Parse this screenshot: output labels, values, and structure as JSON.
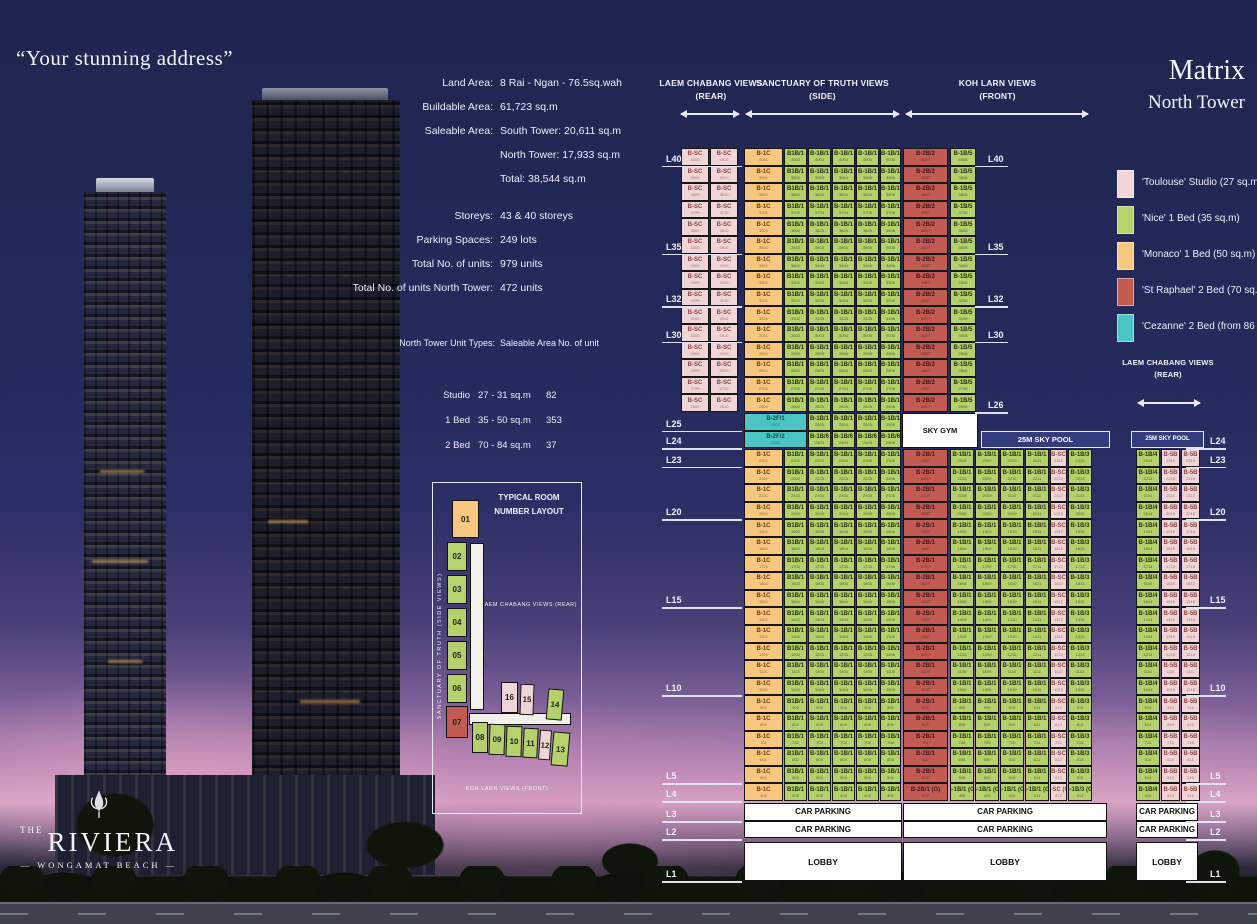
{
  "page": {
    "quote": "“Your stunning address”"
  },
  "title": {
    "main": "Matrix",
    "sub": "North Tower"
  },
  "logo": {
    "the": "THE",
    "name": "RIVIERA",
    "sub": "— WONGAMAT BEACH —"
  },
  "project_details": {
    "rows": [
      {
        "label": "Land Area:",
        "value": "8 Rai - Ngan - 76.5sq.wah"
      },
      {
        "label": "Buildable Area:",
        "value": "61,723 sq.m"
      },
      {
        "label": "Saleable Area:",
        "value": "South Tower: 20,611 sq.m"
      },
      {
        "label": "",
        "value": "North Tower: 17,933 sq.m"
      },
      {
        "label": "",
        "value": "Total: 38,544 sq.m"
      },
      {
        "label": "Storeys:",
        "value": "43 & 40 storeys"
      },
      {
        "label": "Parking Spaces:",
        "value": "249 lots"
      },
      {
        "label": "Total No. of units:",
        "value": "979 units"
      },
      {
        "label": "Total No. of units North Tower:",
        "value": "472 units"
      }
    ]
  },
  "unit_types": {
    "headers": [
      "North Tower Unit Types:",
      "Saleable Area",
      "No. of unit"
    ],
    "rows": [
      [
        "Studio",
        "27 - 31 sq.m",
        "82"
      ],
      [
        "1 Bed",
        "35 - 50 sq.m",
        "353"
      ],
      [
        "2 Bed",
        "70 - 84 sq.m",
        "37"
      ]
    ]
  },
  "typical_layout": {
    "title": "TYPICAL ROOM NUMBER LAYOUT",
    "left_label": "SANCTUARY OF TRUTH (SIDE VIEWS)",
    "center_label": "LAEM CHABANG VIEWS (REAR)",
    "bottom_label": "KOH LARN VIEWS (FRONT)",
    "rooms": [
      {
        "num": "01",
        "type": "monaco"
      },
      {
        "num": "02",
        "type": "nice"
      },
      {
        "num": "03",
        "type": "nice"
      },
      {
        "num": "04",
        "type": "nice"
      },
      {
        "num": "05",
        "type": "nice"
      },
      {
        "num": "06",
        "type": "nice"
      },
      {
        "num": "07",
        "type": "straphael"
      },
      {
        "num": "08",
        "type": "nice"
      },
      {
        "num": "09",
        "type": "nice"
      },
      {
        "num": "10",
        "type": "nice"
      },
      {
        "num": "11",
        "type": "nice"
      },
      {
        "num": "12",
        "type": "studio"
      },
      {
        "num": "13",
        "type": "nice"
      },
      {
        "num": "14",
        "type": "nice"
      },
      {
        "num": "15",
        "type": "studio"
      },
      {
        "num": "16",
        "type": "studio"
      }
    ]
  },
  "legend": {
    "items": [
      {
        "name": "'Toulouse'",
        "desc": "Studio (27 sq.m)",
        "type": "studio",
        "color": "#efd5d6"
      },
      {
        "name": "'Nice'",
        "desc": "1 Bed (35 sq.m)",
        "type": "nice",
        "color": "#b4d16c"
      },
      {
        "name": "'Monaco'",
        "desc": "1 Bed (50 sq.m)",
        "type": "monaco",
        "color": "#f7c67f"
      },
      {
        "name": "'St Raphael'",
        "desc": "2 Bed (70 sq.m)",
        "type": "straphael",
        "color": "#c25b52"
      },
      {
        "name": "'Cezanne'",
        "desc": "2 Bed (from 86 sq.m)",
        "type": "cezanne",
        "color": "#4bc5c3"
      }
    ]
  },
  "matrix": {
    "view_headers": [
      {
        "label": "LAEM CHABANG VIEWS",
        "sub": "(REAR)"
      },
      {
        "label": "SANCTUARY OF TRUTH VIEWS",
        "sub": "(SIDE)"
      },
      {
        "label": "KOH LARN VIEWS",
        "sub": "(FRONT)"
      }
    ],
    "strip_header": {
      "label": "LAEM CHABANG VIEWS",
      "sub": "(REAR)"
    },
    "labels": {
      "sky_gym": "SKY GYM",
      "sky_pool": "25M SKY POOL",
      "car_parking": "CAR PARKING",
      "lobby": "LOBBY"
    },
    "g_suffix": "(G)",
    "floors_upper": [
      40,
      39,
      38,
      37,
      36,
      35,
      34,
      33,
      32,
      31,
      30,
      29,
      28,
      27,
      26
    ],
    "floors_lower": [
      23,
      22,
      21,
      20,
      19,
      18,
      17,
      16,
      15,
      14,
      13,
      12,
      11,
      10,
      9,
      8,
      7,
      6,
      5,
      4
    ],
    "floor_labels": {
      "left": [
        "L40",
        "L35",
        "L32",
        "L30",
        "L25",
        "L24",
        "L23",
        "L20",
        "L15",
        "L10",
        "L5",
        "L4",
        "L3",
        "L2",
        "L1"
      ],
      "mid": [
        "L40",
        "L35",
        "L32",
        "L30",
        "L26"
      ],
      "right": [
        "L24",
        "L23",
        "L20",
        "L15",
        "L10",
        "L5",
        "L4",
        "L3",
        "L2",
        "L1"
      ]
    },
    "upper_row": [
      {
        "col": "p1",
        "code": "B-SC",
        "type": "studio",
        "u": "09"
      },
      {
        "col": "p2",
        "code": "B-SC",
        "type": "studio",
        "u": "10"
      },
      {
        "col": "a1",
        "code": "B-1C",
        "type": "monaco",
        "u": "01"
      },
      {
        "col": "a2",
        "code": "B1B/1",
        "type": "nice",
        "u": "02"
      },
      {
        "col": "a3",
        "code": "B-1B/1",
        "type": "nice",
        "u": "03"
      },
      {
        "col": "a4",
        "code": "B-1B/1",
        "type": "nice",
        "u": "04"
      },
      {
        "col": "a5",
        "code": "B-1B/1",
        "type": "nice",
        "u": "05"
      },
      {
        "col": "a6",
        "code": "B-1B/1",
        "type": "nice",
        "u": "06"
      },
      {
        "col": "b1",
        "code": "B-2B/2",
        "type": "straphael",
        "u": "07"
      },
      {
        "col": "b2",
        "code": "B-1B/5",
        "type": "nice",
        "u": "08"
      }
    ],
    "row_l25": [
      {
        "col": "t",
        "code": "B-2F/1",
        "type": "cezanne",
        "u": "01"
      },
      {
        "col": "a3",
        "code": "B-1B/1",
        "type": "nice",
        "u": "03"
      },
      {
        "col": "a4",
        "code": "B-1B/1",
        "type": "nice",
        "u": "04"
      },
      {
        "col": "a5",
        "code": "B-1B/1",
        "type": "nice",
        "u": "05"
      },
      {
        "col": "a6",
        "code": "B-1B/1",
        "type": "nice",
        "u": "06"
      }
    ],
    "row_l24": [
      {
        "col": "t",
        "code": "B-2F/2",
        "type": "cezanne",
        "u": "01"
      },
      {
        "col": "a3",
        "code": "B-1B/6",
        "type": "nice",
        "u": "03"
      },
      {
        "col": "a4",
        "code": "B-1B/6",
        "type": "nice",
        "u": "04"
      },
      {
        "col": "a5",
        "code": "B-1B/6",
        "type": "nice",
        "u": "05"
      },
      {
        "col": "a6",
        "code": "B-1B/6",
        "type": "nice",
        "u": "06"
      }
    ],
    "lower_row": [
      {
        "col": "a1",
        "code": "B-1C",
        "type": "monaco",
        "u": "01"
      },
      {
        "col": "a2",
        "code": "B1B/1",
        "type": "nice",
        "u": "02"
      },
      {
        "col": "a3",
        "code": "B-1B/1",
        "type": "nice",
        "u": "03"
      },
      {
        "col": "a4",
        "code": "B-1B/1",
        "type": "nice",
        "u": "04"
      },
      {
        "col": "a5",
        "code": "B-1B/1",
        "type": "nice",
        "u": "05"
      },
      {
        "col": "a6",
        "code": "B-1B/1",
        "type": "nice",
        "u": "06"
      },
      {
        "col": "b1",
        "code": "B-2B/1",
        "type": "straphael",
        "u": "07",
        "g": true
      },
      {
        "col": "c1",
        "code": "B-1B/1",
        "type": "nice",
        "u": "08",
        "g": true
      },
      {
        "col": "c2",
        "code": "B-1B/1",
        "type": "nice",
        "u": "09",
        "g": true
      },
      {
        "col": "c3",
        "code": "B-1B/1",
        "type": "nice",
        "u": "10",
        "g": true
      },
      {
        "col": "c4",
        "code": "B-1B/1",
        "type": "nice",
        "u": "11",
        "g": true
      },
      {
        "col": "c5",
        "code": "B-SC",
        "type": "studio",
        "u": "12",
        "g": true
      },
      {
        "col": "c6",
        "code": "B-1B/3",
        "type": "nice",
        "u": "13",
        "g": true
      }
    ],
    "strip_row": [
      {
        "col": "s1",
        "code": "B-1B/4",
        "type": "nice",
        "u": "14"
      },
      {
        "col": "s2",
        "code": "B-5B",
        "type": "studio",
        "u": "15"
      },
      {
        "col": "s3",
        "code": "B-5B",
        "type": "studio",
        "u": "16"
      }
    ]
  }
}
